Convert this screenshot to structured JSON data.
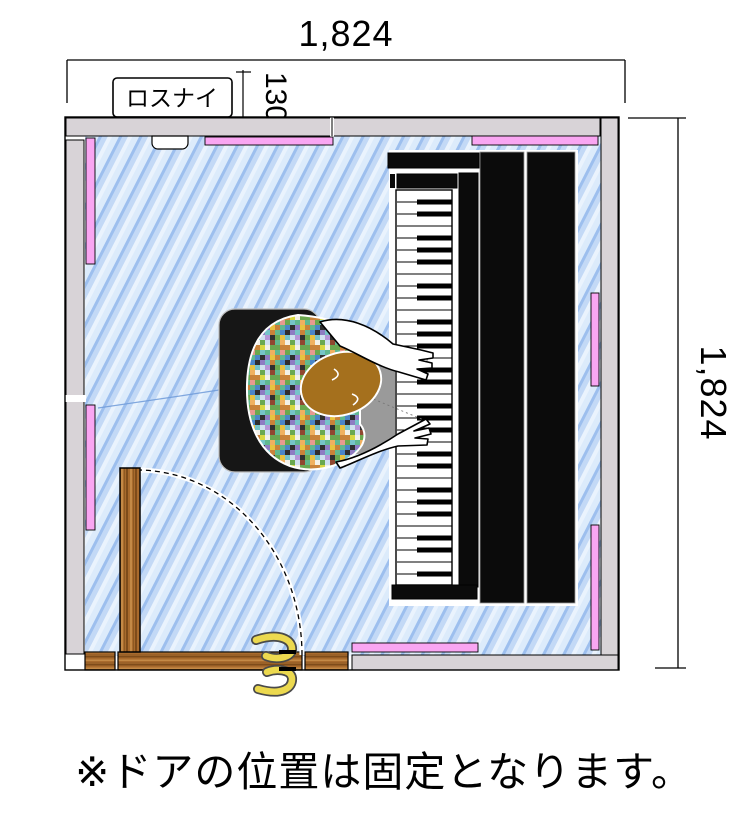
{
  "texts": {
    "dim_top": "1,824",
    "dim_right": "1,824",
    "dim_wall": "130",
    "vent_label": "ロスナイ",
    "note": "※ドアの位置は固定となります。"
  },
  "colors": {
    "floor_base": "#b7d2f2",
    "floor_streak_light": "#e9f2fc",
    "floor_streak_dark": "#9dbfee",
    "wall_gray": "#d8d3d7",
    "panel_pink": "#f9a6f2",
    "wood": "#a96b2d",
    "wood_dark": "#7e4c1a",
    "wood_light": "#c48a46",
    "piano_black": "#0b0b0b",
    "bench_black": "#161616",
    "head_brown": "#a5701d",
    "handle_yellow": "#ecd94f",
    "patchwork": [
      "#c9823a",
      "#76c4c9",
      "#c0392b",
      "#e8c33f",
      "#8e7cc3",
      "#6aa84f",
      "#f3f0e8",
      "#2f2f2f",
      "#b596d8",
      "#e89a90",
      "#4a86c8",
      "#d8d840",
      "#f0b060",
      "#60b890",
      "#904830",
      "#d0e0f0"
    ]
  }
}
